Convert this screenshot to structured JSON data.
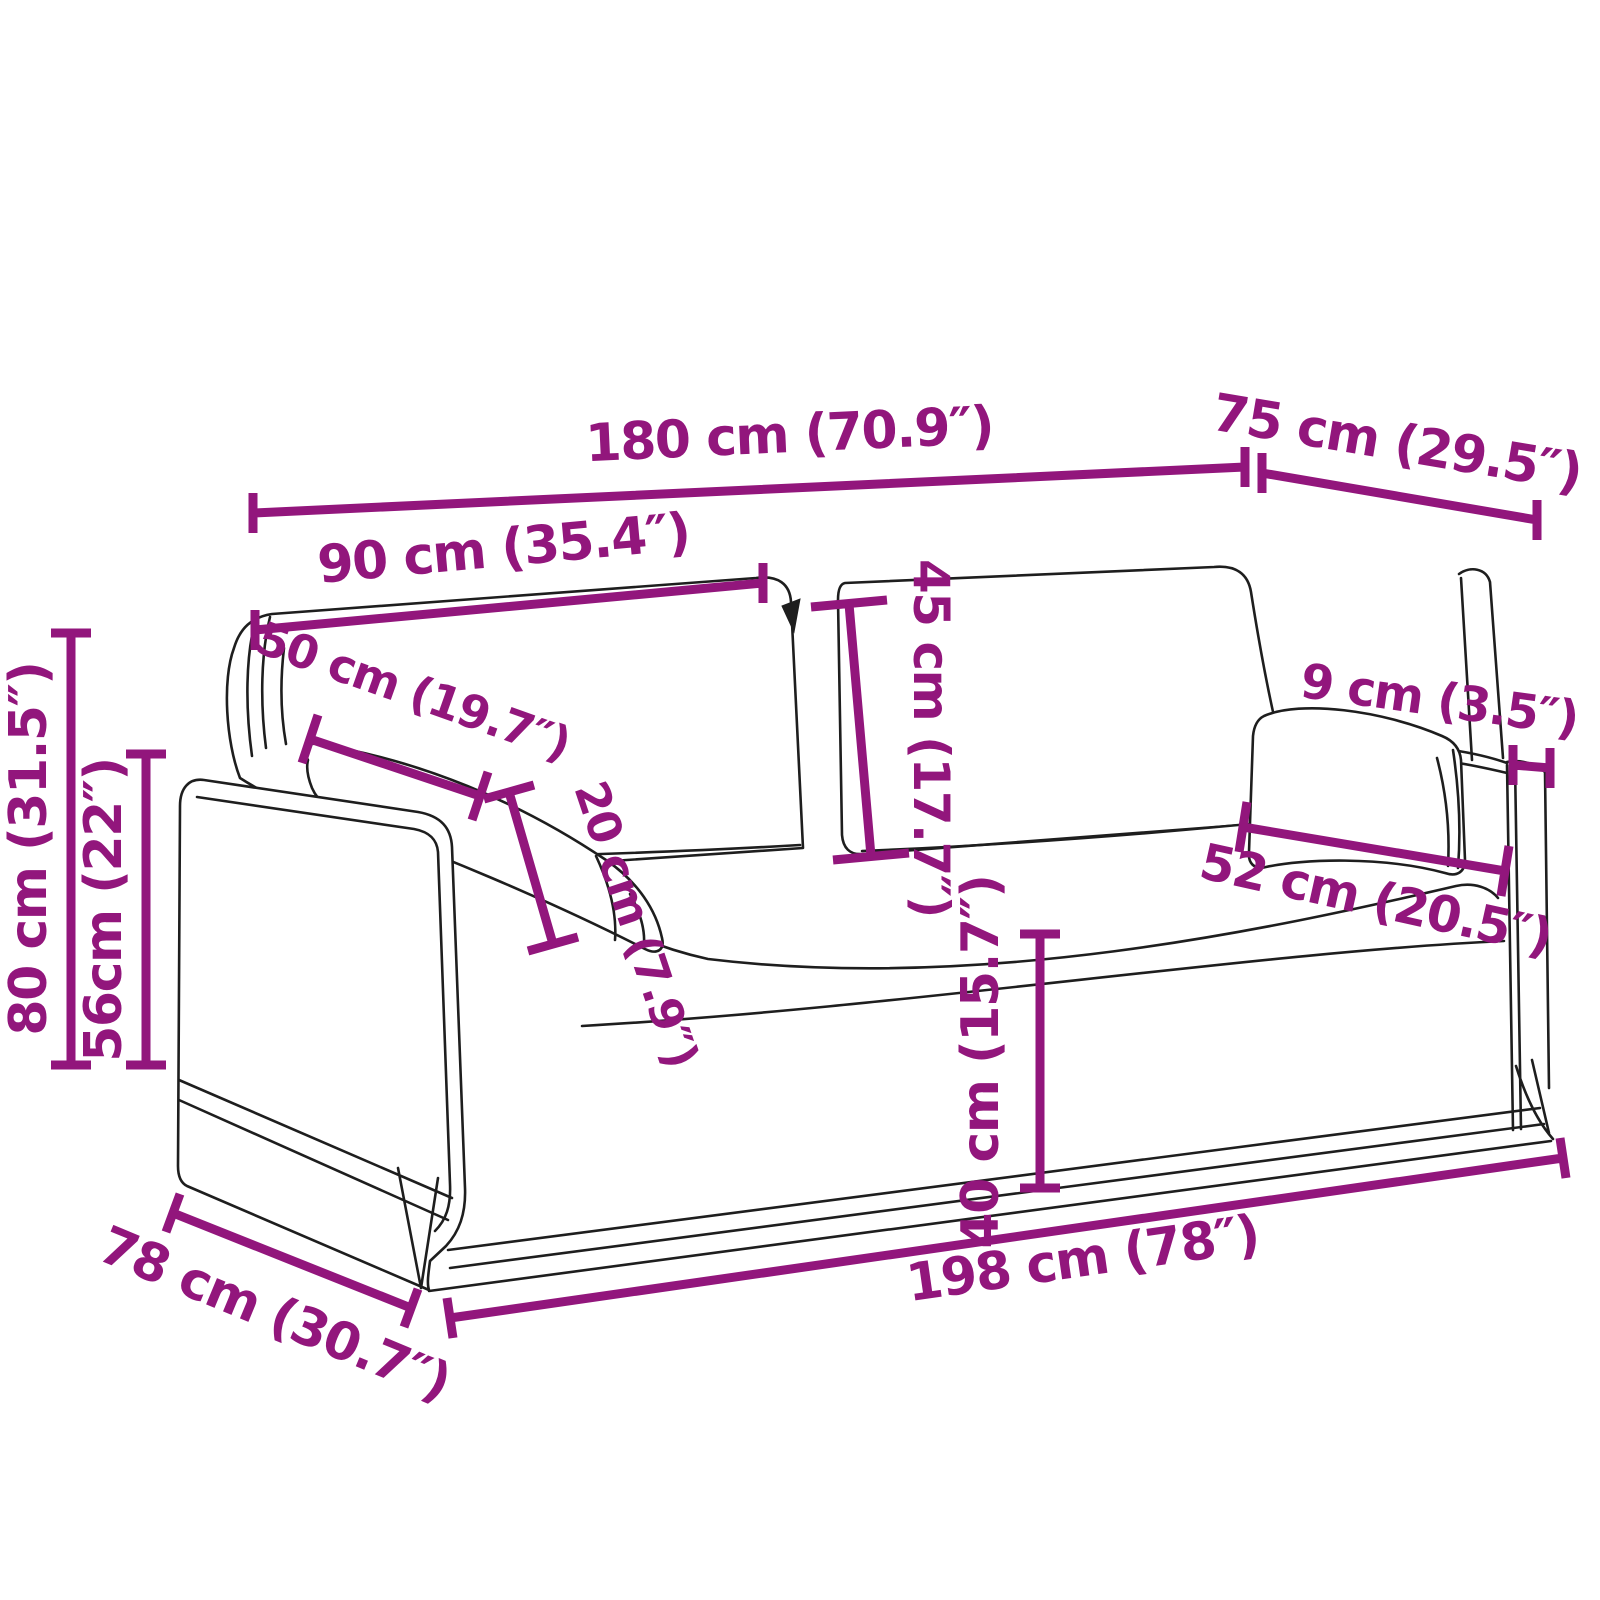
{
  "diagram": {
    "title": "Sofa dimension diagram",
    "kind": "product-dimension-line-drawing",
    "subject": "two-seat slipcover sofa with throw pillows"
  },
  "colors": {
    "dimension": "#92167C",
    "outline": "#1e1e1e",
    "background": "#ffffff"
  },
  "dims": [
    {
      "id": "overall-width-top",
      "label": "180 cm (70.9″)"
    },
    {
      "id": "overall-depth-top",
      "label": "75 cm (29.5″)"
    },
    {
      "id": "backrest-width",
      "label": "90 cm (35.4″)"
    },
    {
      "id": "back-cushion-height",
      "label": "45 cm (17.7″)"
    },
    {
      "id": "pillow-length",
      "label": "50 cm (19.7″)"
    },
    {
      "id": "pillow-thickness",
      "label": "20 cm (7.9″)"
    },
    {
      "id": "armrest-width",
      "label": "9 cm (3.5″)"
    },
    {
      "id": "seat-depth",
      "label": "52 cm (20.5″)"
    },
    {
      "id": "overall-height",
      "label": "80 cm (31.5″)"
    },
    {
      "id": "armrest-height",
      "label": "56cm (22″)"
    },
    {
      "id": "seat-height",
      "label": "40 cm (15.7″)"
    },
    {
      "id": "overall-width-bottom",
      "label": "198 cm (78″)"
    },
    {
      "id": "overall-depth-bottom",
      "label": "78 cm (30.7″)"
    }
  ]
}
